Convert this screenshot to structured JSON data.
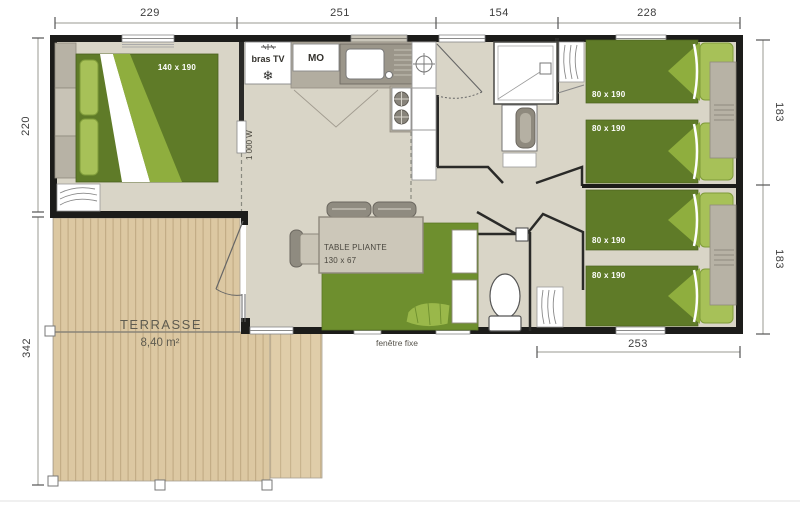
{
  "plan": {
    "dimensions_cm": {
      "top": [
        "229",
        "251",
        "154",
        "228"
      ],
      "left": [
        "220",
        "342"
      ],
      "right": [
        "183",
        "183"
      ],
      "bottom": [
        "253"
      ]
    },
    "rooms": {
      "master_bedroom": {
        "bed_label": "140 x 190"
      },
      "kitchen": {
        "tv_label": "bras TV",
        "fridge_icon": "❄",
        "microwave_label": "MO",
        "heater_label": "1 000 W"
      },
      "living": {
        "table_label_line1": "TABLE PLIANTE",
        "table_label_line2": "130 x 67",
        "window_label": "fenêtre fixe"
      },
      "terrace": {
        "name": "TERRASSE",
        "area": "8,40 m²"
      },
      "bedroom_top": {
        "bed1_label": "80 x 190",
        "bed2_label": "80 x 190"
      },
      "bedroom_bottom": {
        "bed1_label": "80 x 190",
        "bed2_label": "80 x 190"
      }
    },
    "colors": {
      "wall": "#1c1c1a",
      "floor": "#d9d5c7",
      "bed_green": "#5f7b28",
      "bed_green_light": "#8fae3e",
      "pillow_green": "#a7c158",
      "terrace_wood": "#dcc8a2",
      "counter_gray": "#b2ada0"
    }
  }
}
